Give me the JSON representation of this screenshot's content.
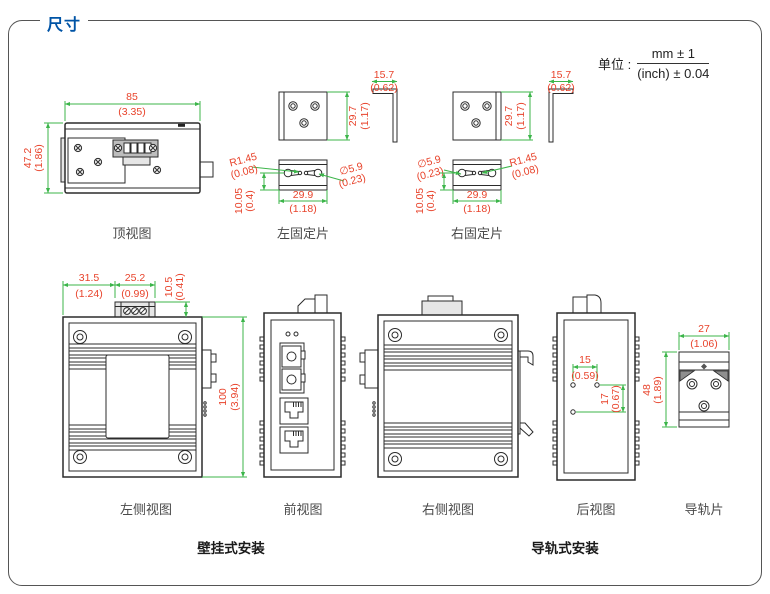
{
  "page": {
    "title": "尺寸",
    "unit_prefix": "单位 :",
    "unit_mm": "mm ± 1",
    "unit_inch": "(inch) ± 0.04"
  },
  "captions": {
    "wall_mount": "壁挂式安装",
    "rail_mount": "导轨式安装"
  },
  "top_view": {
    "label": "顶视图",
    "width_mm": "85",
    "width_in": "(3.35)",
    "height_mm": "47.2",
    "height_in": "(1.86)"
  },
  "left_plate": {
    "label": "左固定片",
    "thk_mm": "15.7",
    "thk_in": "(0.62)",
    "h_mm": "29.7",
    "h_in": "(1.17)",
    "r_mm": "R1.45",
    "r_in": "(0.08)",
    "d_mm": "∅5.9",
    "d_in": "(0.23)",
    "w_mm": "29.9",
    "w_in": "(1.18)",
    "o_mm": "10.05",
    "o_in": "(0.4)"
  },
  "right_plate": {
    "label": "右固定片",
    "thk_mm": "15.7",
    "thk_in": "(0.62)",
    "h_mm": "29.7",
    "h_in": "(1.17)",
    "r_mm": "R1.45",
    "r_in": "(0.08)",
    "d_mm": "∅5.9",
    "d_in": "(0.23)",
    "w_mm": "29.9",
    "w_in": "(1.18)",
    "o_mm": "10.05",
    "o_in": "(0.4)"
  },
  "left_side": {
    "label": "左侧视图",
    "d1_mm": "31.5",
    "d1_in": "(1.24)",
    "d2_mm": "25.2",
    "d2_in": "(0.99)",
    "d3_mm": "10.5",
    "d3_in": "(0.41)",
    "h_mm": "100",
    "h_in": "(3.94)"
  },
  "front_view": {
    "label": "前视图"
  },
  "right_side": {
    "label": "右侧视图"
  },
  "rear_view": {
    "label": "后视图",
    "w_mm": "15",
    "w_in": "(0.59)",
    "h_mm": "17",
    "h_in": "(0.67)"
  },
  "rail_plate": {
    "label": "导轨片",
    "w_mm": "27",
    "w_in": "(1.06)",
    "h_mm": "48",
    "h_in": "(1.89)"
  },
  "colors": {
    "accent_blue": "#0054a6",
    "dim_text": "#e8432b",
    "dim_line": "#3cb54a",
    "line": "#2b2b2b"
  }
}
